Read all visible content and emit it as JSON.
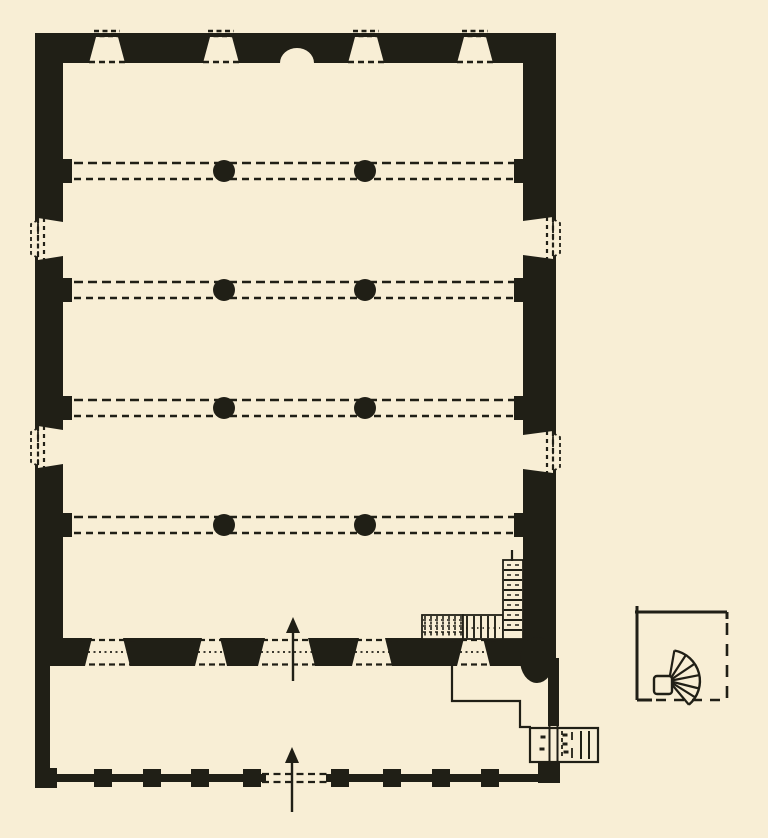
{
  "figure": {
    "width": 768,
    "height": 838,
    "paper_color": "#f8eed5",
    "ink_color": "#201f16",
    "kind": "hand-drawn architectural floor plan, black ink on cream paper"
  },
  "hall": {
    "outer": {
      "x1": 35,
      "y1": 33,
      "x2": 556,
      "y2": 666
    },
    "inner": {
      "x1": 63,
      "y1": 63,
      "x2": 523,
      "y2": 638
    }
  },
  "arcade": {
    "rows_y": [
      171,
      290,
      408,
      525
    ],
    "line_offset": 8,
    "x_start": 74,
    "x_end": 514,
    "columns_x": [
      224,
      365
    ],
    "column_radius": 11,
    "pilaster_w": 9,
    "pilaster_h": 24
  },
  "north_wall_niches": {
    "centers_x": [
      107,
      221,
      366,
      475
    ],
    "top_halfwidth": 11,
    "bottom_halfwidth": 18,
    "top_y": 37,
    "arch": {
      "cx": 297,
      "rx": 17,
      "ry": 15
    }
  },
  "side_niches": {
    "west_centers_y": [
      239,
      447
    ],
    "east_centers_y": [
      238,
      452
    ],
    "inner_halfheight": 17,
    "outer_halfheight": 21,
    "bump_halfheight": 15,
    "bump_depth": 7
  },
  "south_wall": {
    "band_y1": 638,
    "band_y2": 666,
    "openings": [
      [
        85,
        130
      ],
      [
        195,
        227
      ],
      [
        258,
        315
      ],
      [
        352,
        392
      ],
      [
        457,
        490
      ]
    ],
    "splay": 7
  },
  "stair": {
    "hatch_block": {
      "x1": 422,
      "y1": 615,
      "x2": 463,
      "y2": 639,
      "vstep": 6,
      "hstep": 6
    },
    "lined_block": {
      "x1": 463,
      "y1": 615,
      "x2": 503,
      "y2": 639,
      "step": 7
    },
    "vertical_flight": {
      "x1": 503,
      "y1": 560,
      "x2": 523,
      "y2": 639,
      "step": 10
    },
    "top_tick": {
      "x": 512,
      "y1": 550,
      "y2": 561
    }
  },
  "courtyard": {
    "west_wall": {
      "x1": 35,
      "y1": 666,
      "x2": 50,
      "y2": 788
    },
    "south_band": {
      "y1": 774,
      "y2": 782,
      "x1": 48,
      "x2": 540,
      "gap_x1": 266,
      "gap_x2": 326
    },
    "corner_left": {
      "x1": 35,
      "y1": 768,
      "x2": 57,
      "y2": 788
    },
    "piers_x": [
      103,
      152,
      200,
      252,
      340,
      392,
      441,
      490
    ],
    "pier_halfwidth": 9,
    "pier_y1": 769,
    "pier_y2": 787,
    "east_wall_solid": {
      "x1": 548,
      "y1": 658,
      "x2": 559,
      "y2": 726
    },
    "east_wall_lines": {
      "xa": 549.5,
      "xb": 557.5,
      "y1": 724,
      "y2": 762
    },
    "corner_blob": {
      "x1": 538,
      "y1": 758,
      "x2": 560,
      "y2": 783
    },
    "apse_bulge": {
      "cx": 537,
      "cy": 660,
      "rx": 17,
      "ry": 23
    }
  },
  "annex": {
    "outline": [
      [
        452,
        666
      ],
      [
        452,
        701
      ],
      [
        520,
        701
      ],
      [
        520,
        727
      ],
      [
        531,
        727
      ]
    ],
    "vestibule": {
      "x1": 530,
      "y1": 728,
      "x2": 598,
      "y2": 762
    },
    "steps_x": [
      581,
      589
    ],
    "dashed_step_x": 562,
    "partial_step_x": 572,
    "marks": [
      [
        543,
        737
      ],
      [
        542,
        749
      ],
      [
        565,
        735
      ],
      [
        565,
        744
      ],
      [
        566,
        752
      ]
    ]
  },
  "entrance_arrows": [
    {
      "x": 293,
      "tip_y": 617,
      "tail_y": 681
    },
    {
      "x": 292,
      "tip_y": 747,
      "tail_y": 812
    }
  ],
  "detail_inset": {
    "square": {
      "x1": 637,
      "y1": 612,
      "x2": 727,
      "y2": 700
    },
    "left_tick_top_y": 606,
    "bottom_solid_to_x": 652,
    "newel": {
      "x": 654,
      "y": 676,
      "w": 18,
      "h": 18
    },
    "fan": {
      "pivot_x": 669,
      "pivot_y": 681,
      "radius": 31,
      "start_deg": -80,
      "end_deg": 50,
      "spokes_deg": [
        -57,
        -34,
        -11,
        14,
        32
      ]
    }
  }
}
